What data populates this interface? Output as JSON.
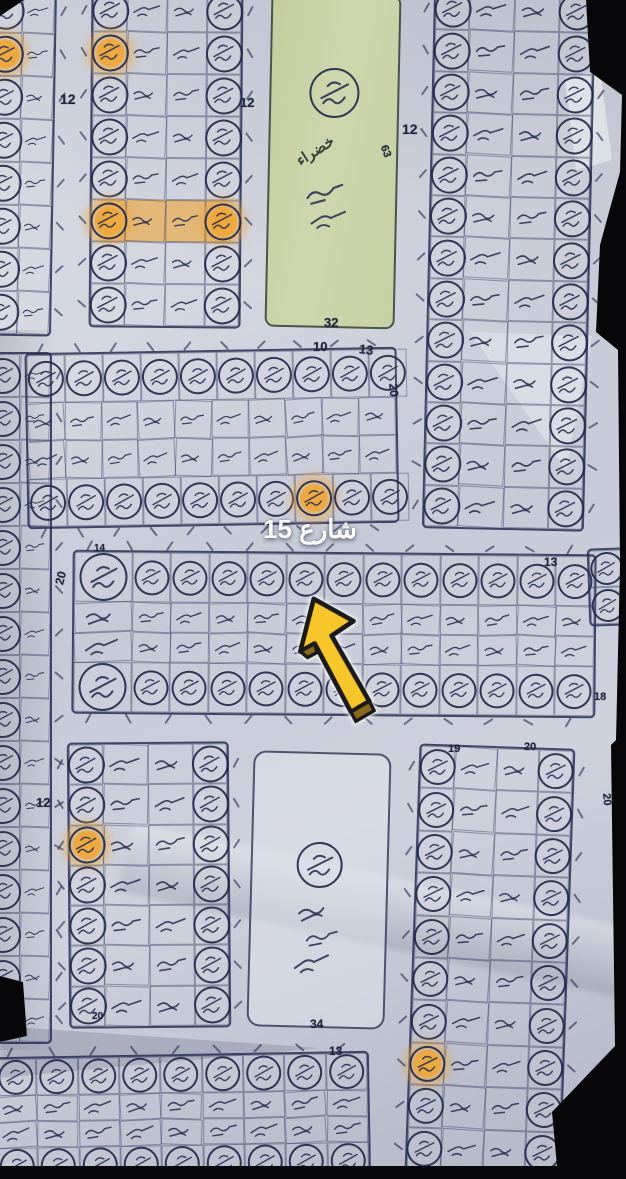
{
  "photo": {
    "background_color": "#07070a",
    "paper_color": "#cdd0db",
    "ink_color": "#272d4f",
    "highlight_color": "#eea63a",
    "green_fill": "#c7d1a3",
    "arrow_fill": "#f5c52a",
    "arrow_outline": "#1a1a1a",
    "arrow_edge": "#8a691d"
  },
  "street_label": {
    "text": "شارع 15"
  },
  "green_area": {
    "label": "خضراء",
    "side_number": "63",
    "bottom_number": "32"
  },
  "park_area": {
    "bottom_number": "34"
  },
  "labels": [
    {
      "t": "12",
      "x": 60,
      "y": 92,
      "s": 14,
      "r": 0
    },
    {
      "t": "12",
      "x": 240,
      "y": 96,
      "s": 13,
      "r": 0
    },
    {
      "t": "12",
      "x": 402,
      "y": 122,
      "s": 14,
      "r": 0
    },
    {
      "t": "10",
      "x": 313,
      "y": 340,
      "s": 13,
      "r": 0
    },
    {
      "t": "13",
      "x": 359,
      "y": 343,
      "s": 13,
      "r": 8
    },
    {
      "t": "20",
      "x": 387,
      "y": 384,
      "s": 12,
      "r": 85
    },
    {
      "t": "14",
      "x": 94,
      "y": 544,
      "s": 10,
      "r": 0
    },
    {
      "t": "20",
      "x": 54,
      "y": 572,
      "s": 12,
      "r": -75
    },
    {
      "t": "13",
      "x": 544,
      "y": 556,
      "s": 12,
      "r": 0
    },
    {
      "t": "18",
      "x": 594,
      "y": 692,
      "s": 11,
      "r": 0
    },
    {
      "t": "12",
      "x": 36,
      "y": 796,
      "s": 13,
      "r": 0
    },
    {
      "t": "19",
      "x": 448,
      "y": 744,
      "s": 11,
      "r": 0
    },
    {
      "t": "20",
      "x": 524,
      "y": 742,
      "s": 11,
      "r": 0
    },
    {
      "t": "20",
      "x": 600,
      "y": 794,
      "s": 11,
      "r": 85
    },
    {
      "t": "13",
      "x": 329,
      "y": 1045,
      "s": 12,
      "r": 0
    },
    {
      "t": "20",
      "x": 92,
      "y": 1012,
      "s": 10,
      "r": 0
    },
    {
      "t": "32",
      "x": 324,
      "y": 316,
      "s": 13,
      "r": 0
    },
    {
      "t": "34",
      "x": 310,
      "y": 1018,
      "s": 12,
      "r": 0
    },
    {
      "t": "63",
      "x": 379,
      "y": 146,
      "s": 11,
      "r": 70
    }
  ],
  "blocks": [
    {
      "name": "plot-block-top-left-edge",
      "x": -16,
      "y": -12,
      "w": 66,
      "h": 344,
      "rot": 1,
      "orient": "v",
      "rows": 8,
      "layout": [
        "circle",
        "cell"
      ],
      "circle": 33,
      "highlights": [
        {
          "r": 1,
          "c": 0
        }
      ],
      "ticks": [
        "right"
      ]
    },
    {
      "name": "plot-block-top-left",
      "x": 90,
      "y": -12,
      "w": 148,
      "h": 336,
      "rot": 0.5,
      "orient": "v",
      "rows": 8,
      "layout": [
        "circle",
        "cell",
        "cell",
        "circle"
      ],
      "circle": 33,
      "highlights": [
        {
          "r": 1,
          "c": 0
        },
        {
          "r": 5,
          "c": 0
        },
        {
          "r": 5,
          "c": 3
        }
      ],
      "rowHl": [
        5
      ],
      "ticks": [
        "left",
        "right"
      ]
    },
    {
      "name": "plot-block-top-right",
      "x": 428,
      "y": -12,
      "w": 158,
      "h": 538,
      "rot": 1.3,
      "orient": "v",
      "rows": 13,
      "layout": [
        "circle",
        "cell",
        "cell",
        "circle"
      ],
      "circle": 33,
      "ticks": [
        "left",
        "right"
      ]
    },
    {
      "name": "plot-block-left-edge",
      "x": -16,
      "y": 352,
      "w": 64,
      "h": 688,
      "rot": 0,
      "orient": "v",
      "rows": 16,
      "layout": [
        "circle",
        "cell"
      ],
      "circle": 32,
      "ticks": [
        "right"
      ]
    },
    {
      "name": "plot-block-middle",
      "x": 26,
      "y": 350,
      "w": 368,
      "h": 172,
      "rot": -1,
      "orient": "h",
      "cols": 10,
      "layout": [
        "circle",
        "cell",
        "cell",
        "circle"
      ],
      "circle": 32,
      "highlights": [
        {
          "r": 3,
          "c": 7
        }
      ],
      "ticks": [
        "top",
        "bottom"
      ]
    },
    {
      "name": "plot-block-street15-strip",
      "x": 72,
      "y": 552,
      "w": 520,
      "h": 160,
      "rot": 0.5,
      "orient": "h",
      "cols": 13,
      "layout": [
        "circle",
        "cell",
        "cell",
        "circle"
      ],
      "circle": 31,
      "firstWide": true,
      "ticks": [
        "top",
        "bottom"
      ]
    },
    {
      "name": "plot-block-right-stub",
      "x": 588,
      "y": 548,
      "w": 34,
      "h": 74,
      "rot": -2,
      "orient": "v",
      "rows": 2,
      "layout": [
        "circle"
      ],
      "circle": 29
    },
    {
      "name": "plot-block-bottom-left",
      "x": 68,
      "y": 742,
      "w": 158,
      "h": 282,
      "rot": -0.5,
      "orient": "v",
      "rows": 7,
      "layout": [
        "circle",
        "cell",
        "cell",
        "circle"
      ],
      "circle": 33,
      "highlights": [
        {
          "r": 2,
          "c": 0
        }
      ],
      "ticks": [
        "left",
        "right"
      ]
    },
    {
      "name": "plot-block-bottom-right",
      "x": 412,
      "y": 746,
      "w": 152,
      "h": 424,
      "rot": 2,
      "orient": "v",
      "rows": 10,
      "layout": [
        "circle",
        "cell",
        "cell",
        "circle"
      ],
      "circle": 32,
      "highlights": [
        {
          "r": 7,
          "c": 0
        }
      ],
      "ticks": [
        "left",
        "right"
      ]
    },
    {
      "name": "plot-block-bottom-strip",
      "x": -6,
      "y": 1054,
      "w": 372,
      "h": 126,
      "rot": -1,
      "orient": "h",
      "cols": 9,
      "layout": [
        "circle",
        "cell",
        "cell",
        "circle"
      ],
      "circle": 31,
      "ticks": [
        "top"
      ]
    }
  ]
}
